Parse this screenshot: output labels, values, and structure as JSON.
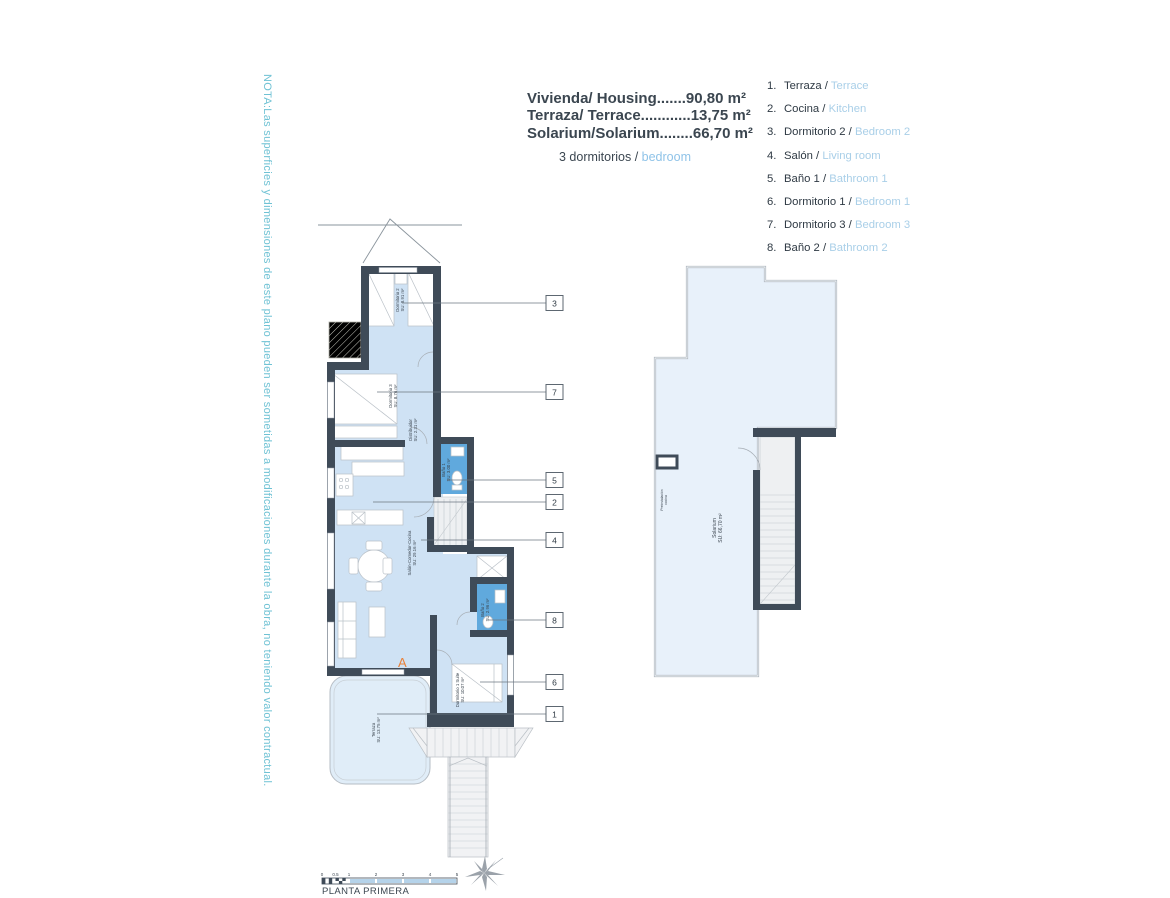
{
  "note": "NOTA:Las superficies y dimensiones de este plano pueden ser sometidas a modificaciones durante la obra, no teniendo valor contractual.",
  "title": {
    "line1": "Vivienda/ Housing.......90,80 m²",
    "line2": "Terraza/ Terrace............13,75 m²",
    "line3": "Solarium/Solarium........66,70 m²",
    "subtitle_prefix": "3 dormitorios / ",
    "subtitle_accent": "bedroom"
  },
  "legend": {
    "items": [
      {
        "num": "1.",
        "es": "Terraza / ",
        "en": "Terrace"
      },
      {
        "num": "2.",
        "es": "Cocina / ",
        "en": "Kitchen"
      },
      {
        "num": "3.",
        "es": "Dormitorio 2 / ",
        "en": "Bedroom 2"
      },
      {
        "num": "4.",
        "es": "Salón / ",
        "en": "Living room"
      },
      {
        "num": "5.",
        "es": "Baño 1 / ",
        "en": "Bathroom 1"
      },
      {
        "num": "6.",
        "es": "Dormitorio 1 / ",
        "en": "Bedroom 1"
      },
      {
        "num": "7.",
        "es": "Dormitorio 3 / ",
        "en": "Bedroom 3"
      },
      {
        "num": "8.",
        "es": "Baño 2 / ",
        "en": "Bathroom 2"
      }
    ]
  },
  "plan": {
    "rooms": {
      "dormitorio2": {
        "name": "Dormitorio 2",
        "area": "SU: 8.91 m²"
      },
      "dormitorio3": {
        "name": "Dormitorio 3",
        "area": "SU: 8.76 m²"
      },
      "distribuidor": {
        "name": "Distribuidor",
        "area": "SU: 2.31 m²"
      },
      "bano1": {
        "name": "Baño 1",
        "area": "SU: 3.00 m²"
      },
      "salon": {
        "name": "Salón-Comedor-Cocina",
        "area": "SU: 29.16 m²"
      },
      "bano2": {
        "name": "Baño 2",
        "area": "SU: 2.96 m²"
      },
      "suite": {
        "name": "Dormitorio 1 Suite",
        "area": "SU: 10.07 m²"
      },
      "terraza": {
        "name": "Terraza",
        "area": "SU: 13.75 m²"
      }
    },
    "block_letter": "A",
    "callouts": {
      "c1": "1",
      "c2": "2",
      "c3": "3",
      "c4": "4",
      "c5": "5",
      "c6": "6",
      "c7": "7",
      "c8": "8"
    }
  },
  "solarium": {
    "name": "Solarium",
    "area": "SU: 66,70 m²",
    "note_line1": "Preinstalación",
    "note_line2": "cocina"
  },
  "scalebar": {
    "t0": "0",
    "t05": "0.5",
    "t1": "1",
    "t2": "2",
    "t3": "3",
    "t4": "4",
    "t5": "5",
    "label": "PLANTA PRIMERA"
  },
  "colors": {
    "wall": "#3f4b58",
    "room_fill": "#cfe2f4",
    "wet_fill": "#60a9dd",
    "terrace_fill": "#e0edf8",
    "solarium_fill": "#e8f1fa",
    "accent_orange": "#e8813a",
    "legend_blue": "#a9cfe8",
    "note_teal": "#6fc2d4",
    "title_dark": "#3b4650"
  }
}
